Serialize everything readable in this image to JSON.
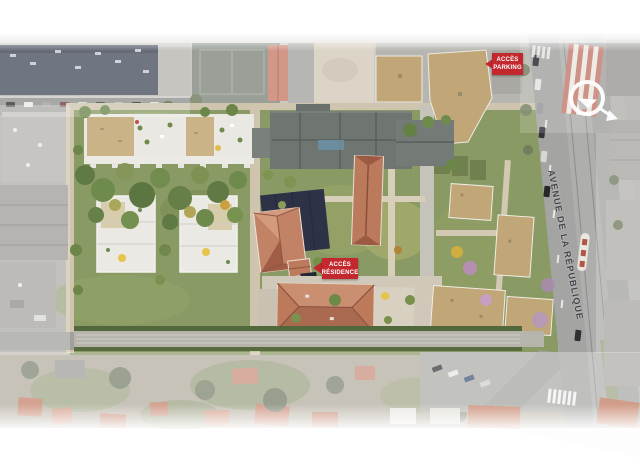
{
  "map": {
    "street_name": "AVENUE DE LA RÉPUBLIQUE",
    "access_labels": [
      {
        "id": "parking",
        "line1": "ACCÈS",
        "line2": "PARKING"
      },
      {
        "id": "residence",
        "line1": "ACCÈS",
        "line2": "RÉSIDENCE"
      }
    ],
    "compass_icon": "north-arrow-compass"
  },
  "colors": {
    "label_red": "#c2282e",
    "roof_terracotta": "#bc7a5c",
    "roof_grey": "#6f7672",
    "roof_tan": "#c1a677",
    "site_green": "#8a9a64",
    "road_grey": "#a4a4a2",
    "dark_building": "#47505e",
    "shadow_navy": "#2e3247",
    "street_text": "#41454a"
  }
}
